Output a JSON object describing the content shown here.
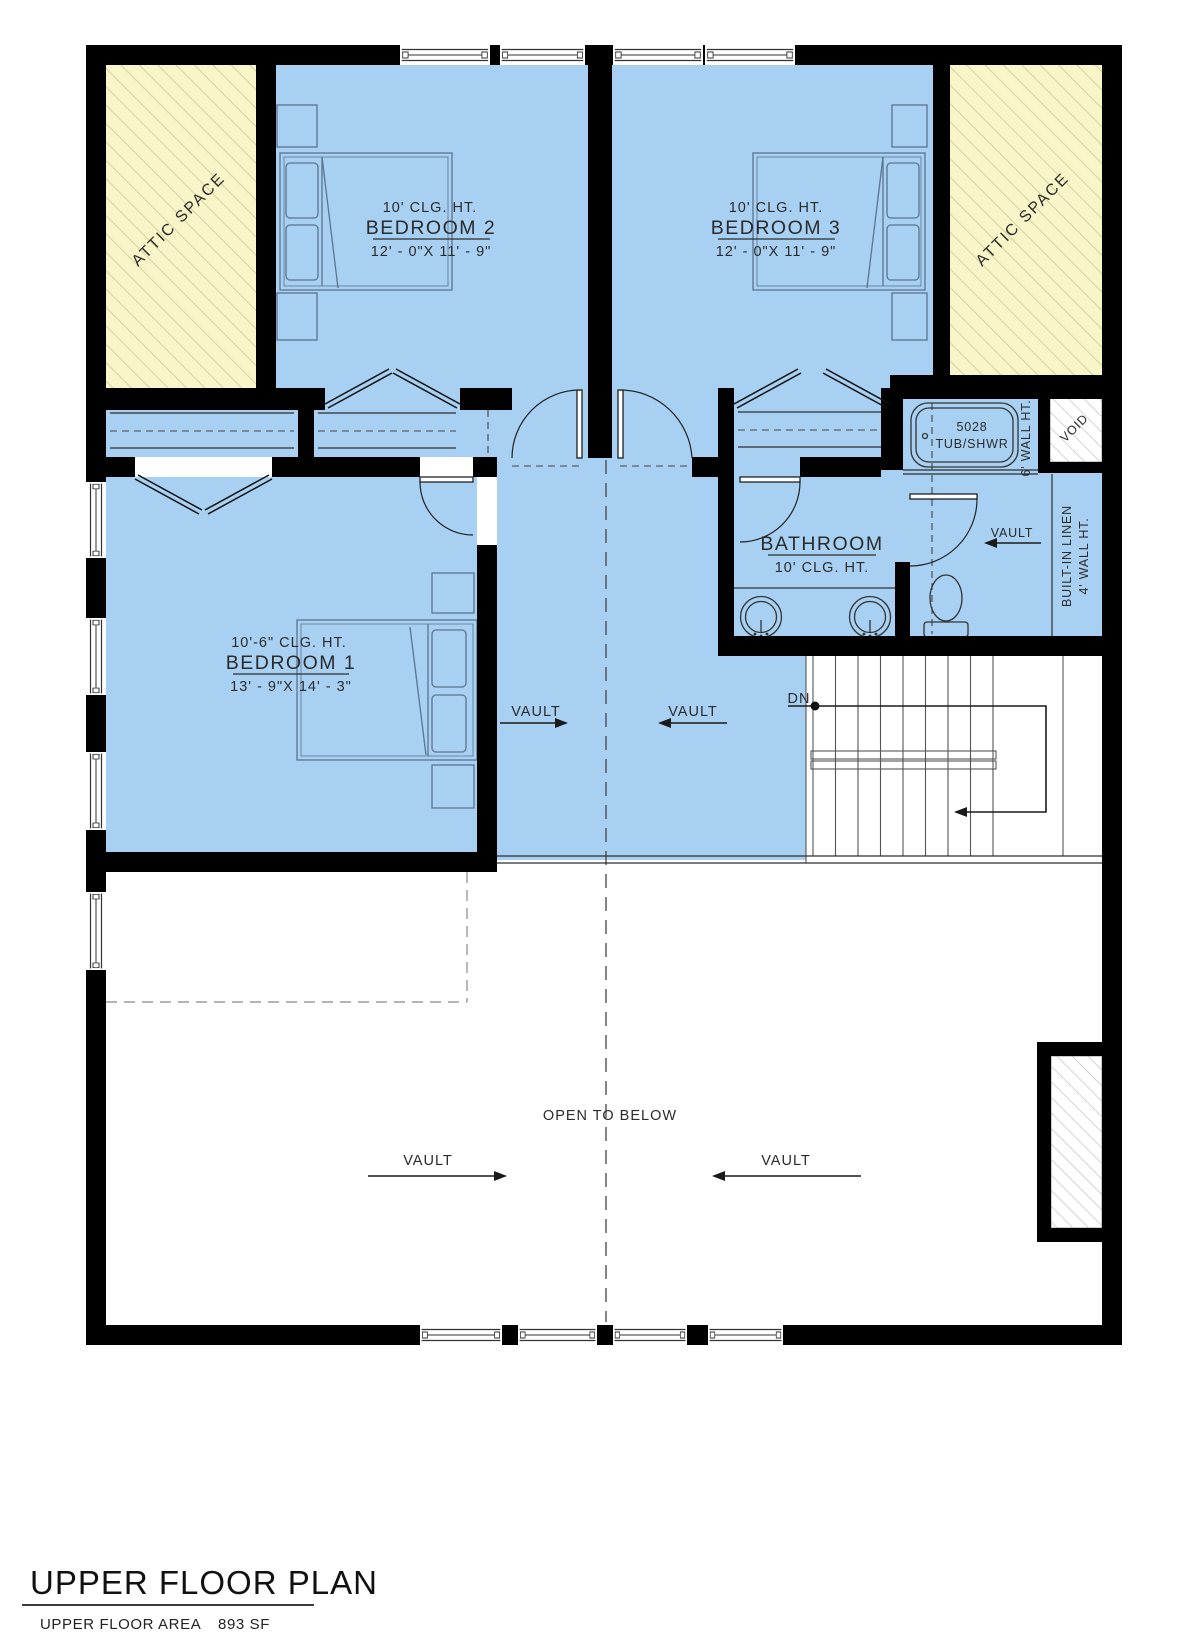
{
  "colors": {
    "room_blue": "#a7d0f2",
    "attic_yellow": "#f8f6c8",
    "attic_hatch": "#d8d4a0",
    "gray_hatch": "#c9c9c9",
    "wall_black": "#000000"
  },
  "attic": {
    "label": "ATTIC SPACE"
  },
  "bedroom2": {
    "ceiling": "10' CLG. HT.",
    "name": "BEDROOM 2",
    "dims": "12' - 0\"X 11' - 9\""
  },
  "bedroom3": {
    "ceiling": "10' CLG. HT.",
    "name": "BEDROOM 3",
    "dims": "12' - 0\"X 11' - 9\""
  },
  "bedroom1": {
    "ceiling": "10'-6\" CLG. HT.",
    "name": "BEDROOM 1",
    "dims": "13' - 9\"X 14' - 3\""
  },
  "bathroom": {
    "name": "BATHROOM",
    "ceiling": "10' CLG. HT."
  },
  "fixtures": {
    "tub_model": "5028",
    "tub_type": "TUB/SHWR"
  },
  "notes": {
    "wall6": "6' WALL HT.",
    "void": "VOID",
    "linen1": "BUILT-IN LINEN",
    "linen2": "4' WALL HT.",
    "dn": "DN",
    "vault": "VAULT",
    "open_below": "OPEN TO BELOW"
  },
  "title": {
    "heading": "UPPER FLOOR PLAN",
    "area_label": "UPPER FLOOR AREA",
    "area_value": "893 SF"
  }
}
